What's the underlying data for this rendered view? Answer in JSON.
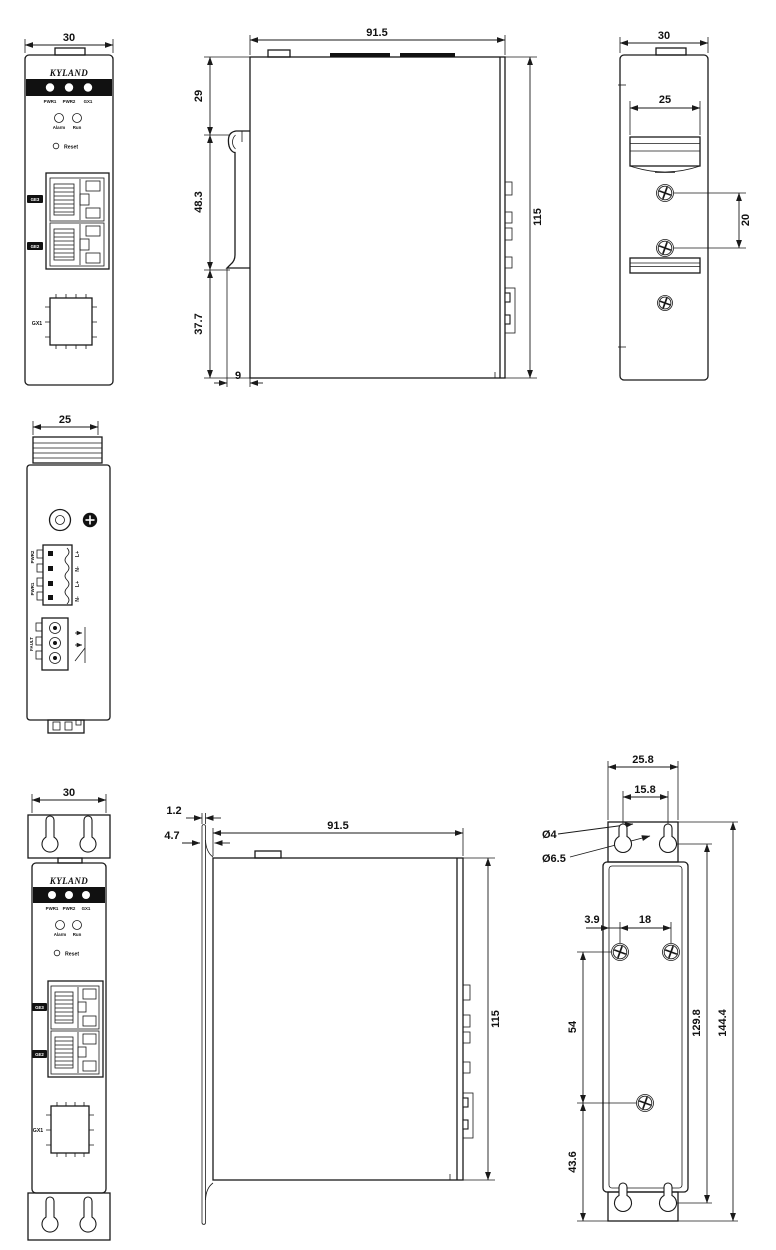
{
  "colors": {
    "line": "#1a1a1a",
    "background": "#ffffff",
    "panel_bar": "#111111"
  },
  "front_panel": {
    "brand": "KYLAND",
    "leds": [
      "PWR1",
      "PWR2",
      "GX1"
    ],
    "status_leds": [
      "Alarm",
      "Run"
    ],
    "reset_label": "Reset",
    "ports": [
      "GE3",
      "GE2",
      "GX1"
    ]
  },
  "top_panel": {
    "power_groups": [
      "PWR2",
      "PWR1"
    ],
    "power_pins": [
      "L+",
      "N-",
      "L+",
      "N-"
    ],
    "relay_label": "FAULT"
  },
  "dimensions_mm": {
    "width_overall": "30",
    "depth_overall": "91.5",
    "height_overall": "115",
    "top_to_clip": "29",
    "clip_length": "48.3",
    "clip_to_bottom": "37.7",
    "clip_inset": "9",
    "rail_width": "25",
    "rail_screw_pitch": "20",
    "top_width": "25",
    "bracket_thickness": "1.2",
    "bracket_offset": "4.7",
    "bracket_width": "25.8",
    "keyhole_pitch": "15.8",
    "keyhole_dia_small": "Ø4",
    "keyhole_dia_large": "Ø6.5",
    "screw_edge_offset": "3.9",
    "screw_pitch_h": "18",
    "screw_pitch_v": "54",
    "screw_to_bottom": "43.6",
    "keyhole_span_v": "129.8",
    "bracket_height": "144.4"
  }
}
